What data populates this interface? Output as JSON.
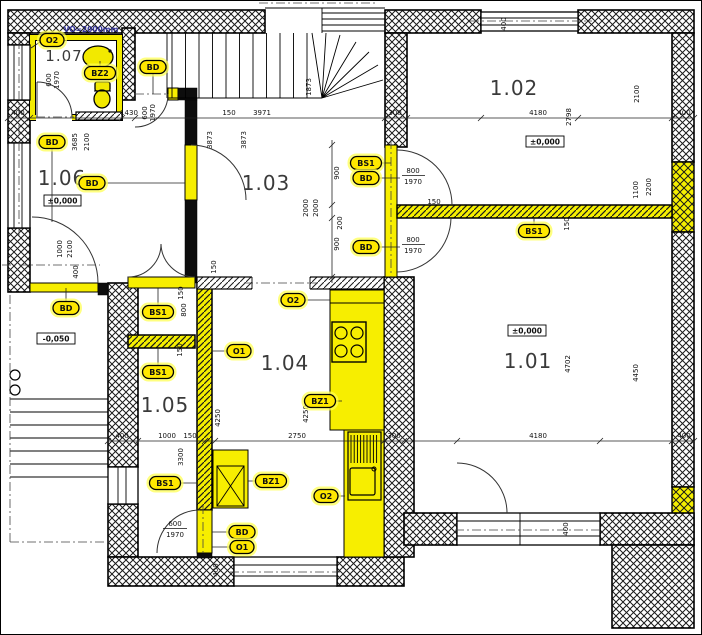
{
  "rooms": {
    "r101": "1.01",
    "r102": "1.02",
    "r103": "1.03",
    "r104": "1.04",
    "r105": "1.05",
    "r106": "1.06",
    "r107": "1.07"
  },
  "levels": {
    "main": "±0,000",
    "terrace": "-0,050"
  },
  "note": {
    "vo": "VO=2000mm"
  },
  "tags": {
    "o1": "O1",
    "o2": "O2",
    "bd": "BD",
    "bs1": "BS1",
    "bz1": "BZ1",
    "bz2": "BZ2"
  },
  "dims": {
    "n150": "150",
    "n200": "200",
    "n300": "300",
    "n400": "400",
    "n600": "600",
    "n800": "800",
    "n900": "900",
    "n1000": "1000",
    "n1100": "1100",
    "n1430": "1430",
    "n1873": "1873",
    "n1970": "1970",
    "n2000": "2000",
    "n2100": "2100",
    "n2200": "2200",
    "n2750": "2750",
    "n2798": "2798",
    "n3300": "3300",
    "n3685": "3685",
    "n3873": "3873",
    "n3971": "3971",
    "n4180": "4180",
    "n4250": "4250",
    "n4450": "4450",
    "n4702": "4702"
  },
  "colors": {
    "highlight": "#F7EE00",
    "halo": "#FFFF4D",
    "wall": "#0D0D0D",
    "note_text": "#333399"
  }
}
